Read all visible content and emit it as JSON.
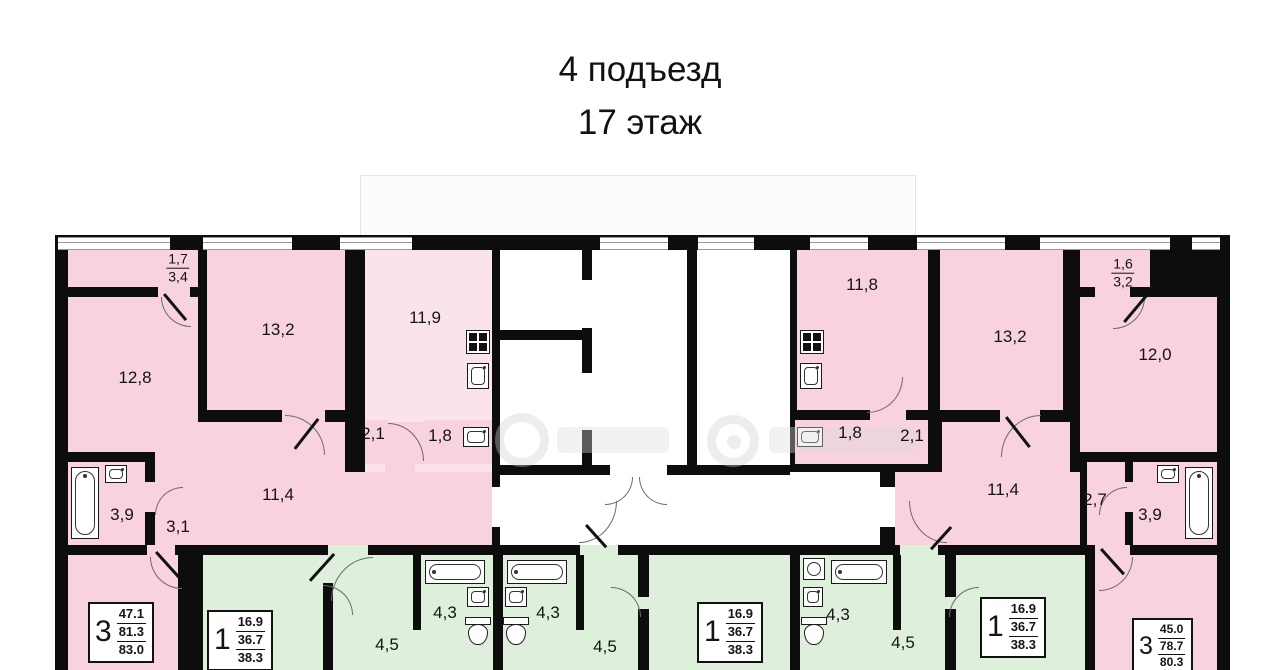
{
  "title": {
    "line1": "4 подъезд",
    "line2": "17 этаж"
  },
  "colors": {
    "wall": "#0d0d0d",
    "pink": "#f8d2dc",
    "pink_light": "#fbe3ea",
    "green": "#def0dc",
    "window_line": "#999999",
    "label": "#141414"
  },
  "rooms": {
    "balcony_left": {
      "reduced": "1,7",
      "full": "3,4"
    },
    "room_12_8": "12,8",
    "room_13_2_left": "13,2",
    "room_11_9": "11,9",
    "corridor_2_1_left": "2,1",
    "wc_1_8_left": "1,8",
    "bath_3_9_left": "3,9",
    "corridor_3_1": "3,1",
    "hall_11_4_left": "11,4",
    "room_11_8": "11,8",
    "room_13_2_right": "13,2",
    "balcony_right": {
      "reduced": "1,6",
      "full": "3,2"
    },
    "room_12_0": "12,0",
    "wc_1_8_right": "1,8",
    "corridor_2_1_right": "2,1",
    "hall_11_4_right": "11,4",
    "corridor_2_7": "2,7",
    "bath_3_9_right": "3,9",
    "bath_4_3_a": "4,3",
    "bath_4_3_b": "4,3",
    "bath_4_3_c": "4,3",
    "hall_4_5_a": "4,5",
    "hall_4_5_b": "4,5",
    "hall_4_5_c": "4,5"
  },
  "apartments": {
    "apt3_left": {
      "rooms": "3",
      "living": "47.1",
      "area": "81.3",
      "total": "83.0"
    },
    "apt1_a": {
      "rooms": "1",
      "living": "16.9",
      "area": "36.7",
      "total": "38.3"
    },
    "apt1_b": {
      "rooms": "1",
      "living": "16.9",
      "area": "36.7",
      "total": "38.3"
    },
    "apt1_c": {
      "rooms": "1",
      "living": "16.9",
      "area": "36.7",
      "total": "38.3"
    },
    "apt3_right": {
      "rooms": "3",
      "living": "45.0",
      "area": "78.7",
      "total": "80.3"
    }
  }
}
